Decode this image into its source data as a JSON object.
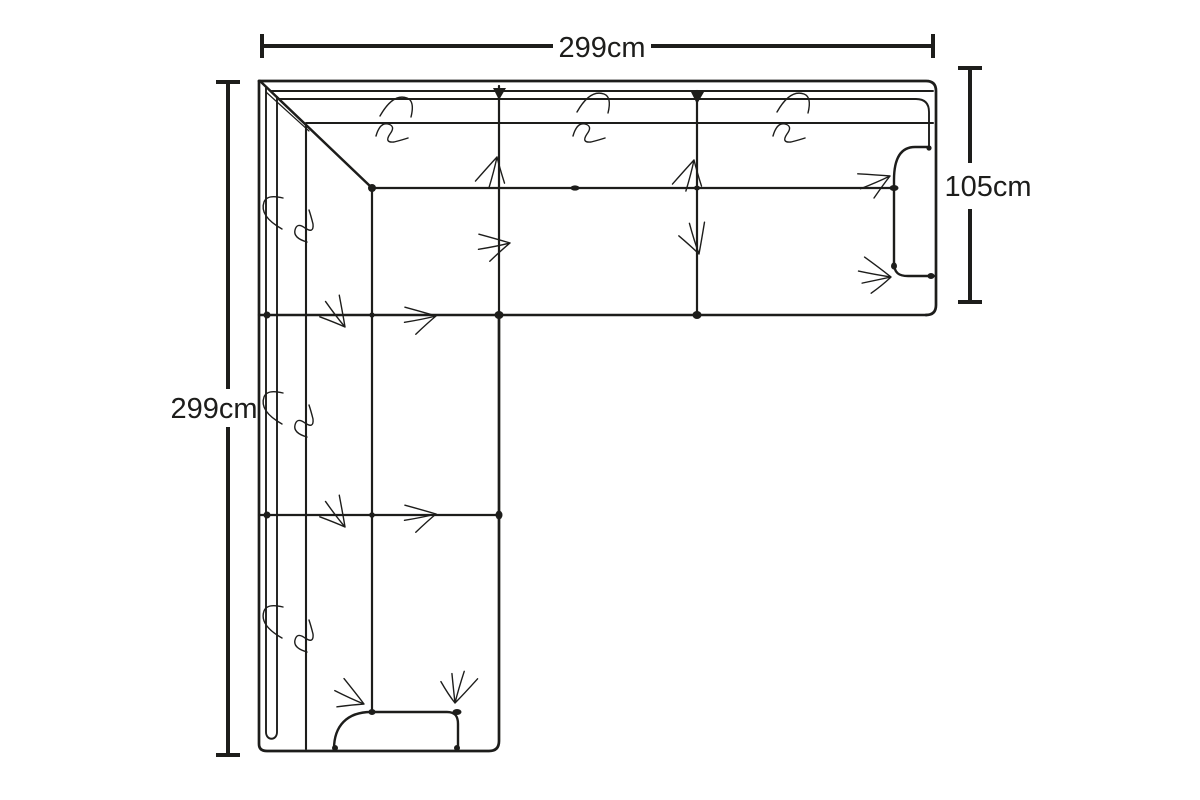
{
  "diagram": {
    "object": "l-shaped corner sofa",
    "view": "top",
    "unit": "cm",
    "colors": {
      "ink": "#1d1d1b",
      "background": "#ffffff"
    },
    "measurements": {
      "top_width": {
        "label": "299cm",
        "value": 299
      },
      "left_depth": {
        "label": "299cm",
        "value": 299
      },
      "right_depth": {
        "label": "105cm",
        "value": 105
      }
    }
  }
}
